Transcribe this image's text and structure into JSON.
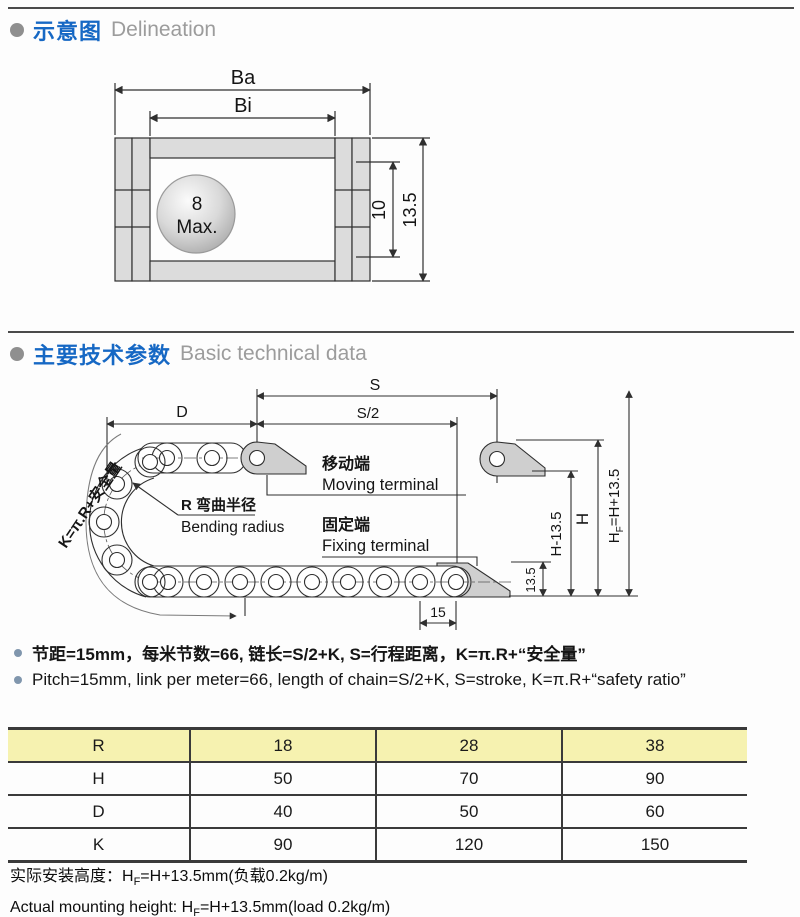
{
  "section1": {
    "title_zh": "示意图",
    "title_en": "Delineation"
  },
  "section2": {
    "title_zh": "主要技术参数",
    "title_en": "Basic technical data"
  },
  "d1": {
    "ba": "Ba",
    "bi": "Bi",
    "ball_top": "8",
    "ball_bottom": "Max.",
    "dim_inner": "10",
    "dim_outer": "13.5"
  },
  "d2": {
    "s": "S",
    "s2": "S/2",
    "d": "D",
    "k": "K=π.R+安全量",
    "move_zh": "移动端",
    "move_en": "Moving terminal",
    "fix_zh": "固定端",
    "fix_en": "Fixing terminal",
    "r_zh": "R 弯曲半径",
    "r_en": "Bending radius",
    "dim15": "15",
    "dim135": "13.5",
    "h_minus": "H-13.5",
    "h": "H",
    "hf_pre": "H",
    "hf_sub": "F",
    "hf_post": "=H+13.5"
  },
  "notes": {
    "zh": "节距=15mm，每米节数=66, 链长=S/2+K, S=行程距离，K=π.R+“安全量”",
    "en": "Pitch=15mm, link per meter=66, length of chain=S/2+K, S=stroke, K=π.R+“safety ratio”"
  },
  "table": {
    "header": [
      "R",
      "18",
      "28",
      "38"
    ],
    "rows": [
      [
        "H",
        "50",
        "70",
        "90"
      ],
      [
        "D",
        "40",
        "50",
        "60"
      ],
      [
        "K",
        "90",
        "120",
        "150"
      ]
    ]
  },
  "footer": {
    "zh_pre": "实际安装高度：H",
    "zh_sub": "F",
    "zh_post": "=H+13.5mm(负载0.2kg/m)",
    "en_pre": "Actual mounting height: H",
    "en_sub": "F",
    "en_post": "=H+13.5mm(load 0.2kg/m)"
  }
}
